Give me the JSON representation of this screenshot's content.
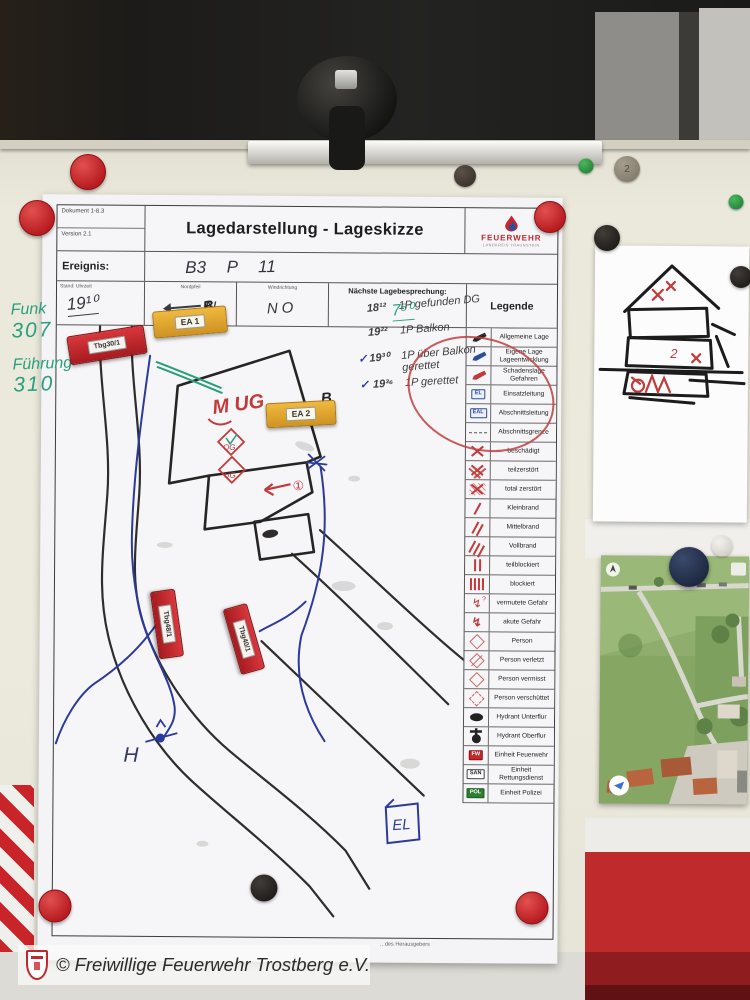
{
  "caption": "© Freiwillige Feuerwehr Trostberg e.V.",
  "form": {
    "doc_no": "Dokument 1-8.3",
    "version": "Version 2.1",
    "title": "Lagedarstellung - Lageskizze",
    "logo": {
      "name": "FEUERWEHR",
      "sub": "LANDKREIS TRAUNSTEIN"
    },
    "fields": {
      "ereignis_label": "Ereignis:",
      "ereignis_value": "B3 P 11",
      "stand_label": "Stand: Uhrzeit",
      "stand_value": "19¹⁰",
      "nordpfeil_label": "Nordpfeil",
      "nordpfeil_value": "N",
      "windrichtung_label": "Windrichtung",
      "windrichtung_value": "NO",
      "besprechung_label": "Nächste Lagebesprechung:",
      "besprechung_value": "7⁵⁰",
      "legende_label": "Legende"
    },
    "fine_print": "…des Herausgebers"
  },
  "legend": {
    "items": [
      {
        "label": "Allgemeine Lage",
        "sym": "pen-black"
      },
      {
        "label": "Eigene Lage Lageentwicklung",
        "sym": "pen-blue"
      },
      {
        "label": "Schadenslage Gefahren",
        "sym": "pen-red"
      },
      {
        "label": "Einsatzleitung",
        "sym": "box-el",
        "text": "EL"
      },
      {
        "label": "Abschnittsleitung",
        "sym": "box-eal",
        "text": "EAL"
      },
      {
        "label": "Abschnittsgrenze",
        "sym": "dashline"
      },
      {
        "label": "beschädigt",
        "sym": "x1"
      },
      {
        "label": "teilzerstört",
        "sym": "x2"
      },
      {
        "label": "total zerstört",
        "sym": "x3"
      },
      {
        "label": "Kleinbrand",
        "sym": "slash1"
      },
      {
        "label": "Mittelbrand",
        "sym": "slash2"
      },
      {
        "label": "Vollbrand",
        "sym": "slash3"
      },
      {
        "label": "teilblockiert",
        "sym": "bars2"
      },
      {
        "label": "blockiert",
        "sym": "bars4"
      },
      {
        "label": "vermutete Gefahr",
        "sym": "zigzag-q"
      },
      {
        "label": "akute Gefahr",
        "sym": "zigzag"
      },
      {
        "label": "Person",
        "sym": "diamond"
      },
      {
        "label": "Person verletzt",
        "sym": "diamond-slash"
      },
      {
        "label": "Person vermisst",
        "sym": "diamond"
      },
      {
        "label": "Person verschüttet",
        "sym": "diamond-dash"
      },
      {
        "label": "Hydrant Unterflur",
        "sym": "hyd-u"
      },
      {
        "label": "Hydrant Oberflur",
        "sym": "hyd-o"
      },
      {
        "label": "Einheit Feuerwehr",
        "sym": "box-fw",
        "text": "FW"
      },
      {
        "label": "Einheit Rettungsdienst",
        "sym": "box-san",
        "text": "SAN"
      },
      {
        "label": "Einheit Polizei",
        "sym": "box-pol",
        "text": "POL"
      }
    ]
  },
  "notes": {
    "lines": [
      {
        "check": "",
        "time": "18¹²",
        "text": "1P gefunden DG"
      },
      {
        "check": "",
        "time": "19²²",
        "text": "1P Balkon"
      },
      {
        "check": "✓",
        "time": "19³⁰",
        "text": "1P über Balkon gerettet"
      },
      {
        "check": "✓",
        "time": "19³⁶",
        "text": "1P gerettet"
      }
    ]
  },
  "margin_notes": {
    "funk": "Funk",
    "funk_no": "307",
    "fuehrung": "Führung",
    "fuehrung_no": "310"
  },
  "map": {
    "markers": [
      {
        "label": "EA 1",
        "kind": "yellow"
      },
      {
        "label": "EA 2",
        "kind": "yellow"
      },
      {
        "label": "Tbg30/1",
        "kind": "red"
      },
      {
        "label": "Tbg48/1",
        "kind": "red"
      },
      {
        "label": "Tbg40/1",
        "kind": "red"
      }
    ],
    "annotations": {
      "b1": "B",
      "b2": "B",
      "m_ug": "M UG",
      "og": "OG",
      "ug": "UG",
      "circle_one": "①",
      "el": "EL",
      "h": "H"
    }
  },
  "magnets": {
    "gray_label": "2"
  },
  "colors": {
    "brand_red": "#c3272b",
    "board": "#eceadc",
    "pen_blue": "#2b3a9e",
    "pen_red": "#c23a3a",
    "pen_green": "#27a07e"
  }
}
